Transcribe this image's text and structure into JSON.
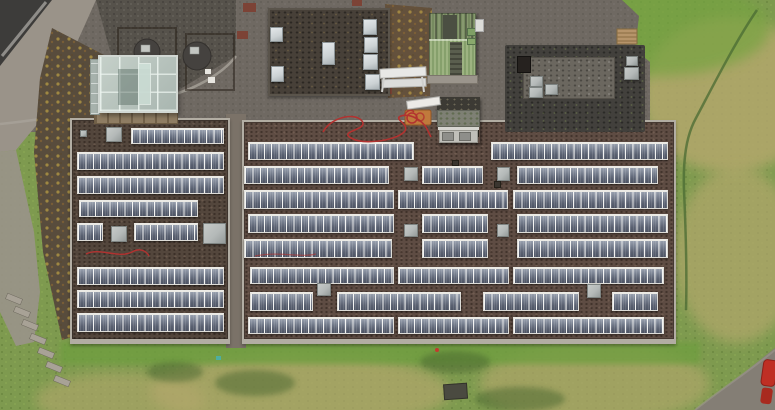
{
  "meta": {
    "description": "Aerial top-down drone photograph of a flat-roofed building complex covered with rows of solar panels, surrounded by asphalt yard, gravel, a glass greenhouse, a green metal shed and grass with dry patches",
    "width_px": 775,
    "height_px": 410
  },
  "palette": {
    "grass": "#7e9a4f",
    "grass_bright": "#74a33f",
    "grass_dry": "#b3a76c",
    "grass_dark": "#47652f",
    "asphalt": "#6f6962",
    "road_light": "#9a9389",
    "gravel_dark": "#56524b",
    "leaf_ground": "#584c3c",
    "walkway": "#7b7268",
    "parapet": "#b2ada3",
    "roof_left": "#53463c",
    "roof_main": "#5e4c43",
    "panel_dark": "#596070",
    "panel_light": "#98a0ae",
    "panel_frame": "#dddcd7",
    "skylight_gray": "#b4b9b8",
    "skylight_white": "#ccd2d4",
    "dark_roof": "#474038",
    "dark_zone": "#42403c",
    "shed_green": "#8ea873",
    "mossy_top": "#3c3a34",
    "mossy_mid": "#7e8074",
    "concrete": "#c0bfb9",
    "wood": "#b6946a",
    "cable_red": "#b23230",
    "machine_orange": "#c07a3c",
    "car_red": "#bf2f24",
    "brick_red": "#7c4336",
    "steps": "#a8a296"
  },
  "scene": {
    "roofs": [
      {
        "id": "left-roof",
        "x": 70,
        "y": 118,
        "w": 160,
        "h": 226,
        "base": "#53463c",
        "rows": [
          {
            "y": 128,
            "h": 16,
            "segs": [
              [
                131,
                224
              ]
            ]
          },
          {
            "y": 152,
            "h": 18,
            "segs": [
              [
                77,
                224
              ]
            ]
          },
          {
            "y": 176,
            "h": 18,
            "segs": [
              [
                77,
                224
              ]
            ]
          },
          {
            "y": 200,
            "h": 17,
            "segs": [
              [
                79,
                198
              ]
            ]
          },
          {
            "y": 223,
            "h": 18,
            "segs": [
              [
                77,
                103
              ],
              [
                134,
                198
              ]
            ]
          },
          {
            "y": 267,
            "h": 18,
            "segs": [
              [
                77,
                224
              ]
            ]
          },
          {
            "y": 290,
            "h": 18,
            "segs": [
              [
                77,
                224
              ]
            ]
          },
          {
            "y": 313,
            "h": 19,
            "segs": [
              [
                77,
                224
              ]
            ]
          }
        ],
        "skylights": [
          {
            "x": 106,
            "y": 127,
            "w": 16,
            "h": 15
          },
          {
            "x": 111,
            "y": 226,
            "w": 16,
            "h": 16
          },
          {
            "x": 203,
            "y": 223,
            "w": 23,
            "h": 21
          },
          {
            "x": 80,
            "y": 130,
            "w": 7,
            "h": 7
          }
        ],
        "vents": []
      },
      {
        "id": "main-roof",
        "x": 242,
        "y": 120,
        "w": 434,
        "h": 224,
        "base": "#5e4c43",
        "rows": [
          {
            "y": 142,
            "h": 18,
            "segs": [
              [
                248,
                414
              ],
              [
                491,
                668
              ]
            ]
          },
          {
            "y": 166,
            "h": 18,
            "segs": [
              [
                244,
                389
              ],
              [
                422,
                483
              ],
              [
                517,
                658
              ]
            ]
          },
          {
            "y": 190,
            "h": 19,
            "segs": [
              [
                244,
                394
              ],
              [
                398,
                508
              ],
              [
                513,
                668
              ]
            ]
          },
          {
            "y": 214,
            "h": 19,
            "segs": [
              [
                248,
                394
              ],
              [
                422,
                488
              ],
              [
                517,
                668
              ]
            ]
          },
          {
            "y": 239,
            "h": 19,
            "segs": [
              [
                244,
                392
              ],
              [
                422,
                488
              ],
              [
                517,
                668
              ]
            ]
          },
          {
            "y": 267,
            "h": 17,
            "segs": [
              [
                250,
                394
              ],
              [
                398,
                509
              ],
              [
                513,
                664
              ]
            ]
          },
          {
            "y": 292,
            "h": 19,
            "segs": [
              [
                250,
                313
              ],
              [
                337,
                461
              ],
              [
                483,
                579
              ],
              [
                612,
                658
              ]
            ]
          },
          {
            "y": 317,
            "h": 17,
            "segs": [
              [
                248,
                394
              ],
              [
                398,
                509
              ],
              [
                513,
                664
              ]
            ]
          }
        ],
        "skylights": [
          {
            "x": 404,
            "y": 167,
            "w": 14,
            "h": 14
          },
          {
            "x": 497,
            "y": 167,
            "w": 13,
            "h": 14
          },
          {
            "x": 404,
            "y": 224,
            "w": 14,
            "h": 13
          },
          {
            "x": 497,
            "y": 224,
            "w": 12,
            "h": 13
          },
          {
            "x": 317,
            "y": 283,
            "w": 14,
            "h": 13
          },
          {
            "x": 587,
            "y": 284,
            "w": 14,
            "h": 14
          }
        ],
        "vents": [
          {
            "x": 470,
            "y": 129,
            "w": 9,
            "h": 8
          },
          {
            "x": 494,
            "y": 181,
            "w": 7,
            "h": 7
          },
          {
            "x": 452,
            "y": 160,
            "w": 7,
            "h": 6
          }
        ]
      }
    ],
    "upper_building": {
      "x": 268,
      "y": 8,
      "w": 122,
      "h": 88,
      "skylights": [
        {
          "x": 270,
          "y": 27,
          "w": 13,
          "h": 15
        },
        {
          "x": 271,
          "y": 66,
          "w": 13,
          "h": 16
        },
        {
          "x": 322,
          "y": 42,
          "w": 13,
          "h": 23
        },
        {
          "x": 363,
          "y": 19,
          "w": 14,
          "h": 16
        },
        {
          "x": 364,
          "y": 37,
          "w": 14,
          "h": 16
        },
        {
          "x": 363,
          "y": 54,
          "w": 15,
          "h": 16
        },
        {
          "x": 365,
          "y": 74,
          "w": 15,
          "h": 16
        }
      ]
    },
    "right_building": {
      "x": 505,
      "y": 45,
      "w": 140,
      "h": 87,
      "inner": {
        "x": 523,
        "y": 57,
        "w": 92,
        "h": 42
      },
      "chimney": {
        "x": 517,
        "y": 56,
        "w": 14,
        "h": 17
      },
      "vents": [
        {
          "x": 530,
          "y": 76,
          "w": 13,
          "h": 11
        },
        {
          "x": 529,
          "y": 87,
          "w": 14,
          "h": 11
        },
        {
          "x": 545,
          "y": 84,
          "w": 13,
          "h": 11
        },
        {
          "x": 626,
          "y": 56,
          "w": 12,
          "h": 10
        },
        {
          "x": 624,
          "y": 67,
          "w": 15,
          "h": 13
        }
      ]
    },
    "objects": [
      "glass-greenhouse",
      "green-shed",
      "mossy-concrete-unit",
      "aluminium-trestles",
      "orange-machine-with-red-hose",
      "red-cable-on-roof",
      "fire-pit-circles",
      "wooden-pallet",
      "stone-steps",
      "grass-storage-box",
      "red-car-partial"
    ]
  }
}
